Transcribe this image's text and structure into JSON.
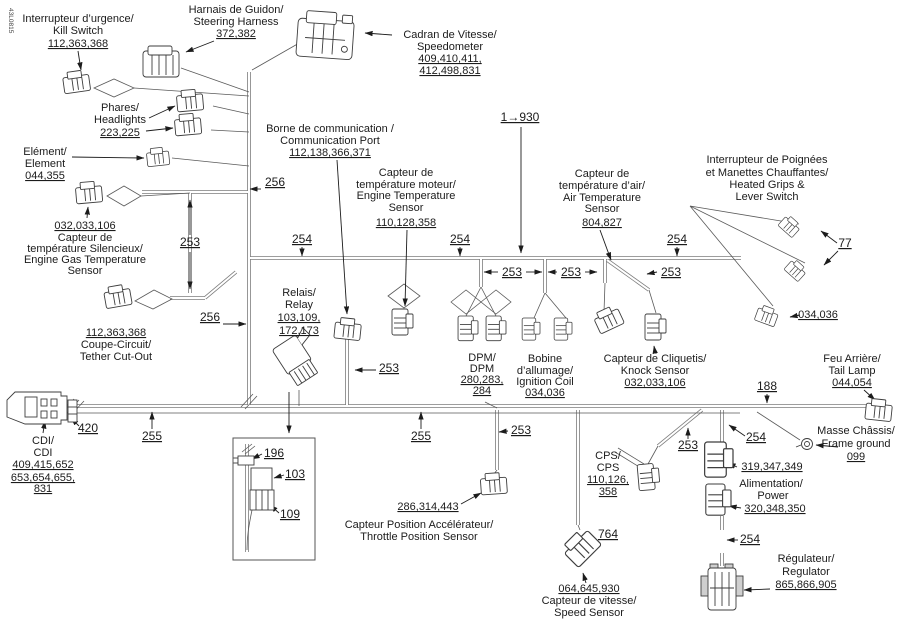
{
  "code": "43L0815",
  "dims": {
    "d253": "253",
    "d254": "254",
    "d255": "255",
    "d256": "256",
    "d188": "188",
    "d420": "420",
    "d77": "77",
    "d764": "764",
    "d196": "196",
    "d103": "103",
    "d109": "109",
    "wire_range": "1→930",
    "grip_connector_num": "034,036"
  },
  "components": {
    "kill_switch": {
      "lines": [
        "Interrupteur d’urgence/",
        "Kill Switch"
      ],
      "nums": [
        "112,363,368"
      ]
    },
    "steering_harness": {
      "lines": [
        "Harnais de Guidon/",
        "Steering Harness"
      ],
      "nums": [
        "372,382"
      ]
    },
    "speedometer": {
      "lines": [
        "Cadran de Vitesse/",
        "Speedometer"
      ],
      "nums": [
        "409,410,411,",
        "412,498,831"
      ]
    },
    "headlights": {
      "lines": [
        "Phares/",
        "Headlights"
      ],
      "nums": [
        "223,225"
      ]
    },
    "element": {
      "lines": [
        "Elément/",
        "Element"
      ],
      "nums": [
        "044,355"
      ]
    },
    "gas_temp_sensor": {
      "nums": [
        "032,033,106"
      ],
      "lines": [
        "Capteur de",
        "température Silencieux/",
        "Engine Gas Temperature",
        "Sensor"
      ]
    },
    "comm_port": {
      "lines": [
        "Borne de communication /",
        "Communication Port"
      ],
      "nums": [
        "112,138,366,371"
      ]
    },
    "engine_temp_sensor": {
      "lines": [
        "Capteur de",
        "température moteur/",
        "Engine Temperature",
        "Sensor"
      ],
      "nums": [
        "110,128,358"
      ]
    },
    "air_temp_sensor": {
      "lines": [
        "Capteur de",
        "température d’air/",
        "Air Temperature",
        "Sensor"
      ],
      "nums": [
        "804,827"
      ]
    },
    "heated_grips": {
      "lines": [
        "Interrupteur de Poignées",
        "et Manettes Chauffantes/",
        "Heated Grips &",
        "Lever Switch"
      ]
    },
    "tether_cutout": {
      "nums": [
        "112,363,368"
      ],
      "lines": [
        "Coupe-Circuit/",
        "Tether Cut-Out"
      ]
    },
    "relay": {
      "lines": [
        "Relais/",
        "Relay"
      ],
      "nums": [
        "103,109,",
        "172,173"
      ]
    },
    "dpm": {
      "lines": [
        "DPM/",
        "DPM"
      ],
      "nums": [
        "280,283,",
        "284"
      ]
    },
    "ignition_coil": {
      "lines": [
        "Bobine",
        "d’allumage/",
        "Ignition Coil"
      ],
      "nums": [
        "034,036"
      ]
    },
    "knock_sensor": {
      "lines": [
        "Capteur de Cliquetis/",
        "Knock Sensor"
      ],
      "nums": [
        "032,033,106"
      ]
    },
    "tail_lamp": {
      "lines": [
        "Feu Arrière/",
        "Tail Lamp"
      ],
      "nums": [
        "044,054"
      ]
    },
    "frame_ground": {
      "lines": [
        "Masse Châssis/",
        "Frame ground"
      ],
      "nums": [
        "099"
      ]
    },
    "cdi": {
      "lines": [
        "CDI/",
        "CDI"
      ],
      "nums": [
        "409,415,652",
        "653,654,655,",
        "831"
      ]
    },
    "throttle_position_sensor": {
      "nums": [
        "286,314,443"
      ],
      "lines": [
        "Capteur Position Accélérateur/",
        "Throttle Position Sensor"
      ]
    },
    "cps": {
      "lines": [
        "CPS/",
        "CPS"
      ],
      "nums": [
        "110,126,",
        "358"
      ]
    },
    "power": {
      "nums_upper": [
        "319,347,349"
      ],
      "lines": [
        "Alimentation/",
        "Power"
      ],
      "nums_lower": [
        "320,348,350"
      ]
    },
    "speed_sensor": {
      "nums": [
        "064,645,930"
      ],
      "lines": [
        "Capteur de vitesse/",
        "Speed Sensor"
      ]
    },
    "regulator": {
      "lines": [
        "Régulateur/",
        "Regulator"
      ],
      "nums": [
        "865,866,905"
      ]
    }
  }
}
